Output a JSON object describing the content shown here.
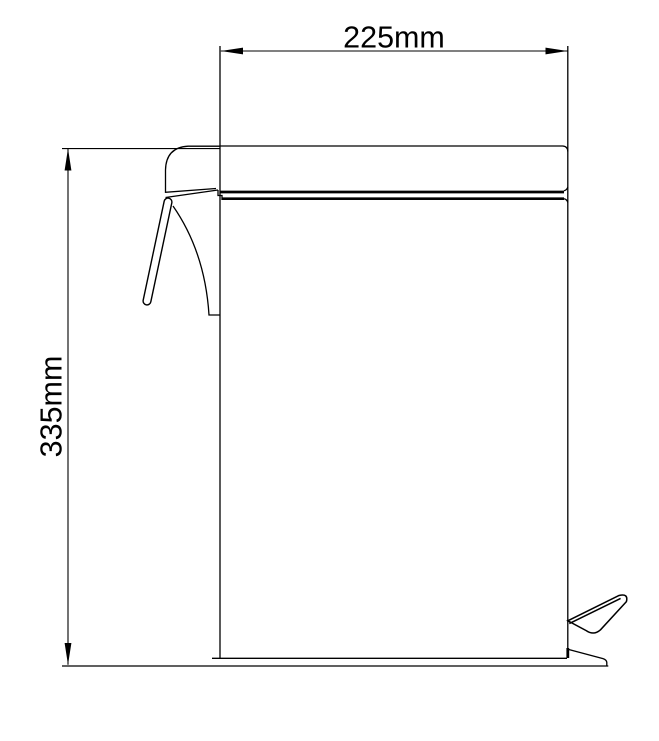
{
  "drawing": {
    "subject": "pedal-bin-side-view-technical-drawing",
    "background_color": "#ffffff",
    "line_color": "#000000",
    "dimensions": {
      "width": {
        "label": "225mm"
      },
      "height": {
        "label": "335mm"
      }
    }
  }
}
